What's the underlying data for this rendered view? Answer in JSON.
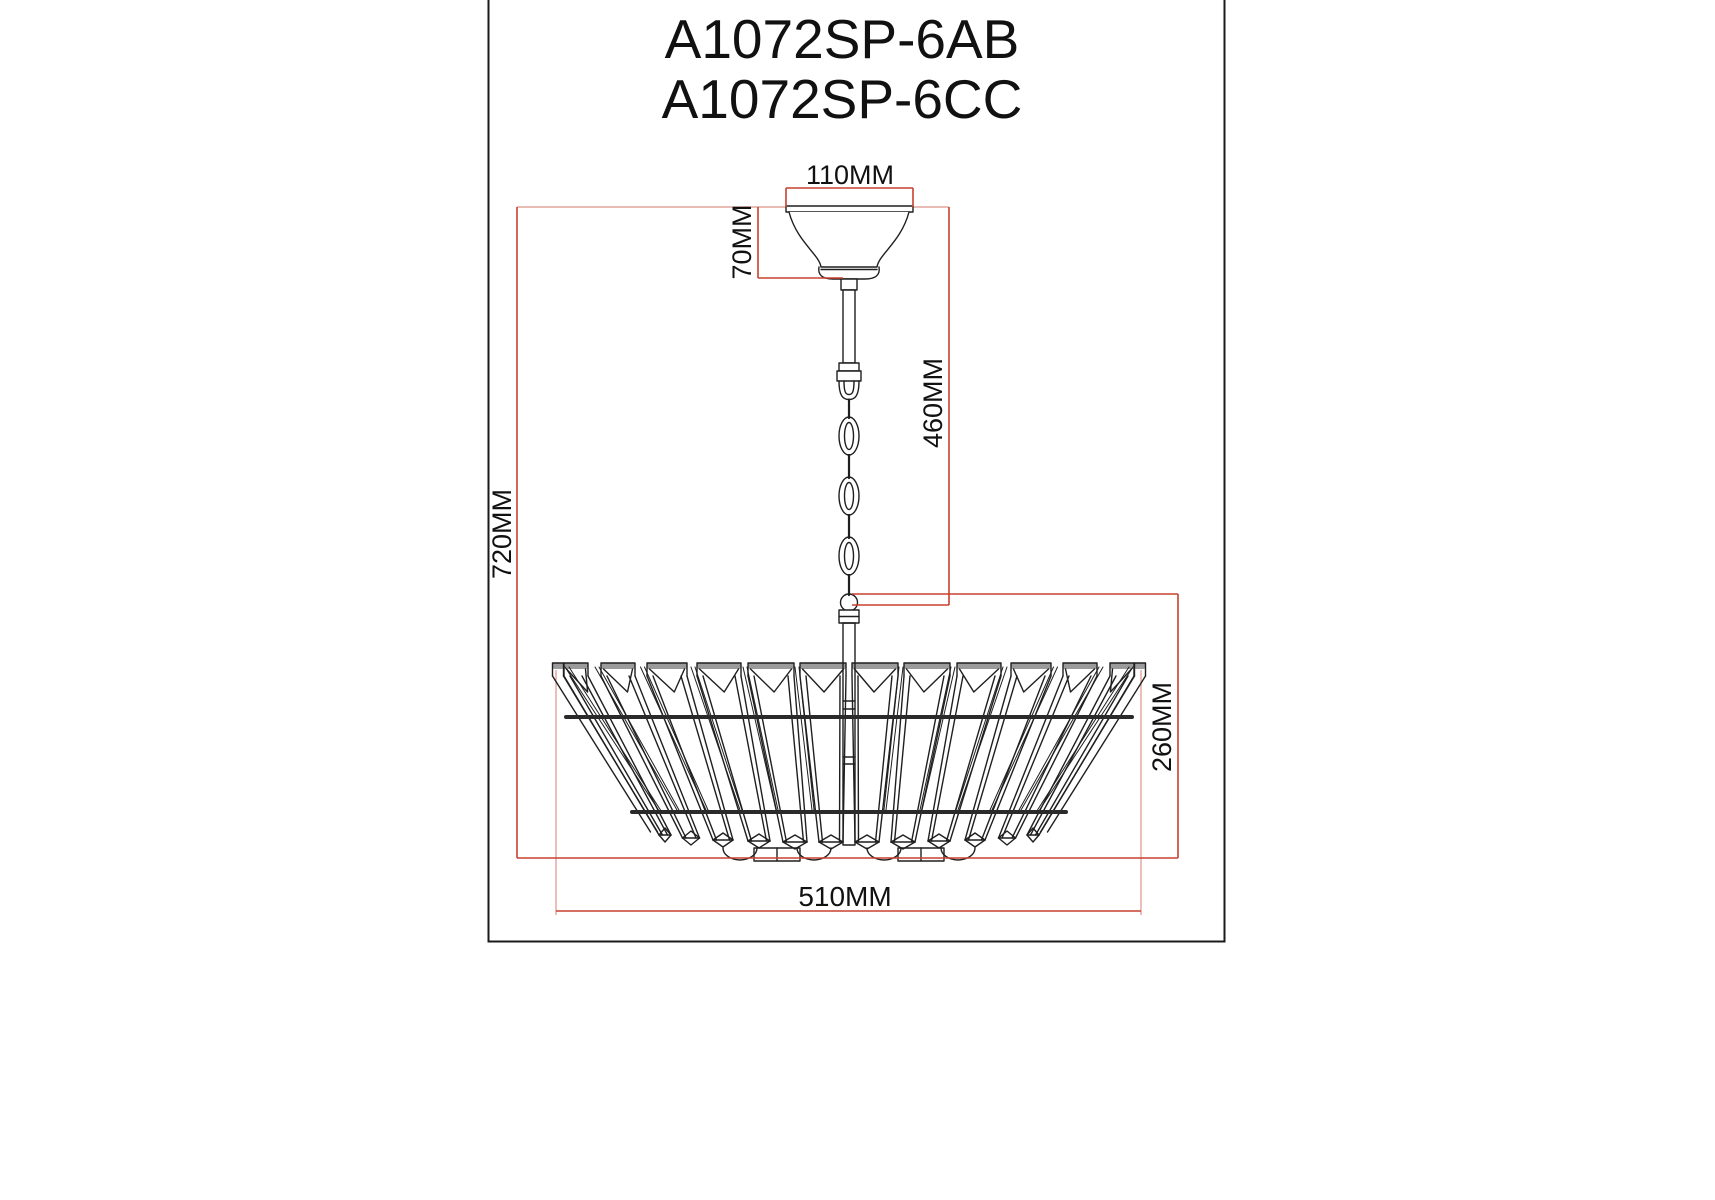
{
  "titles": {
    "line1": "A1072SP-6AB",
    "line2": "A1072SP-6CC"
  },
  "dimensions": {
    "canopy_width": "110MM",
    "canopy_height": "70MM",
    "chain_length": "460MM",
    "total_height": "720MM",
    "shade_height": "260MM",
    "shade_width": "510MM"
  },
  "colors": {
    "dimension_red": "#c8402f",
    "reference_red": "#dd948b",
    "line_black": "#1f1f1f",
    "ring_black": "#2a2a2a",
    "cap_gray": "#9b9b9b"
  }
}
